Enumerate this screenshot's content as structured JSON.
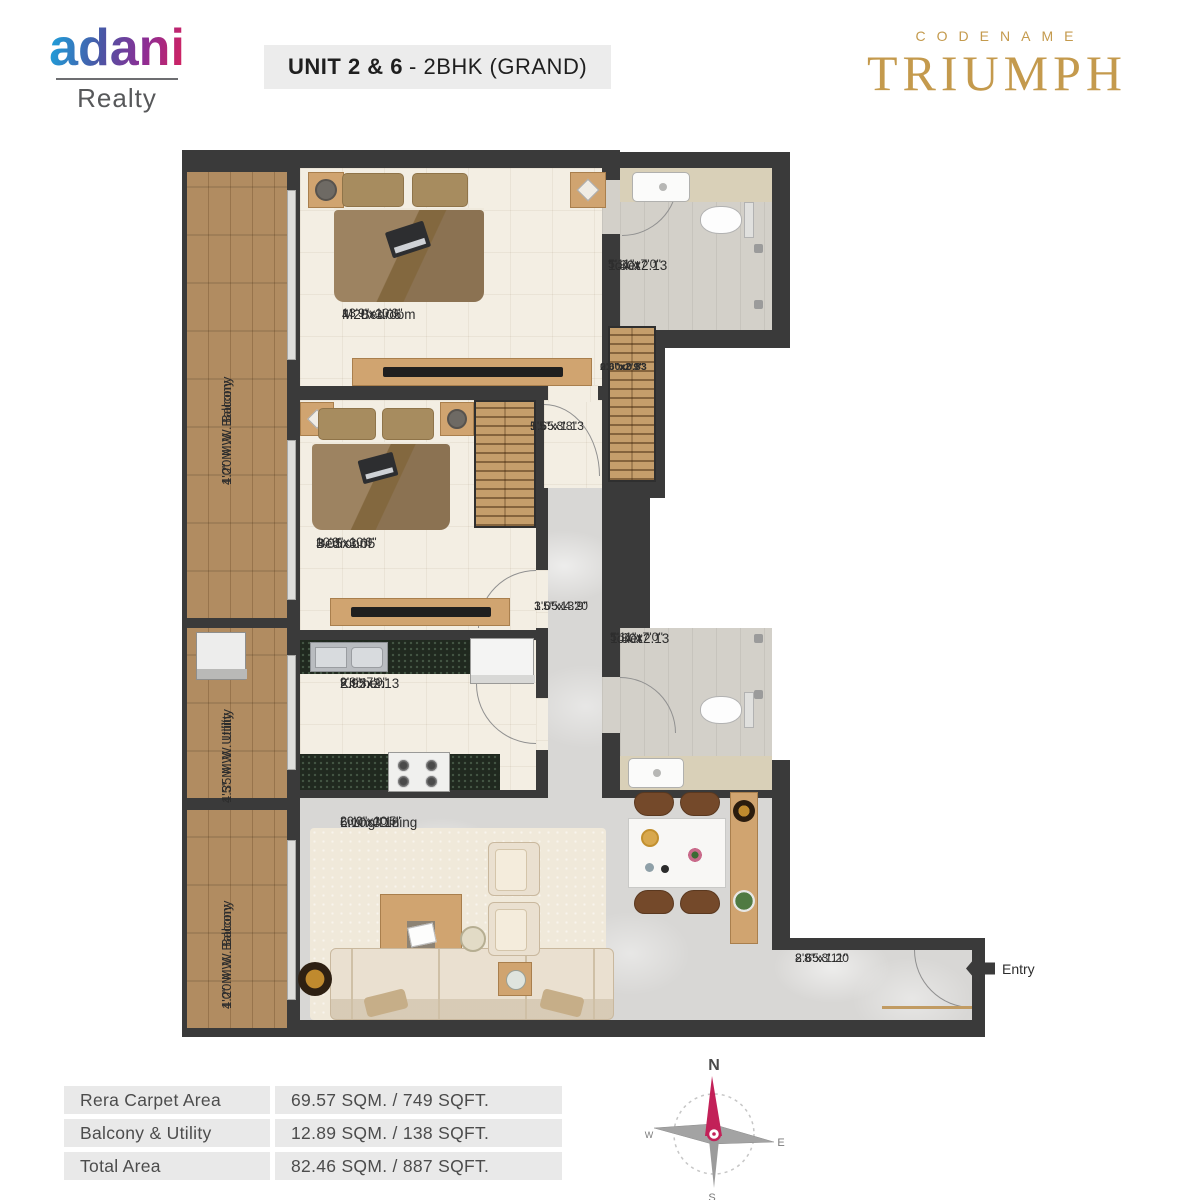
{
  "header": {
    "brand_name": "adani",
    "brand_sub": "Realty",
    "unit_bold": "UNIT 2 & 6",
    "unit_rest": "- 2BHK (GRAND)",
    "project_eyebrow": "CODENAME",
    "project_name": "TRIUMPH"
  },
  "plan": {
    "rooms": [
      {
        "name": "M. Bedroom",
        "metric": "4.20x3.05",
        "imperial": "13'9\"x10'0\""
      },
      {
        "name": "Bedroom",
        "metric": "3.05x3.05",
        "imperial": "10'0\"x10'0\""
      },
      {
        "name": "Kitchen",
        "metric": "2.95x2.13",
        "imperial": "9'8\"x7'0\""
      },
      {
        "name": "Living/Dining",
        "metric": "6.10x3.18",
        "imperial": "20'0\"x10'5\""
      },
      {
        "name": "Toilet",
        "metric": "1.80x2.13",
        "imperial": "5'11\"x7'0\""
      },
      {
        "name": "Toilet",
        "metric": "1.80x2.13",
        "imperial": "5'11\"x7'0\""
      }
    ],
    "spaces": [
      {
        "metric": "1.65x1.13",
        "imperial": "5'5\"x3'8\""
      },
      {
        "metric": "0.60x0.83",
        "imperial": "2'0\"x2'9\""
      },
      {
        "metric": "1.05x4.20",
        "imperial": "3'5\"x13'9\""
      },
      {
        "metric": "2.65x1.20",
        "imperial": "8'8\"x3'11\""
      }
    ],
    "balcony_top": {
      "line1": "1.20 M.W. Balcony",
      "line2": "4'0\" M.W. Balcony"
    },
    "utility": {
      "line1": "1.35 M.W. Utility",
      "line2": "4'5\" M.W. Utility"
    },
    "balcony_bottom": {
      "line1": "1.20 M.W. Balcony",
      "line2": "4'0\" M.W. Balcony"
    },
    "entry_label": "Entry"
  },
  "area_table": {
    "rows": [
      {
        "label": "Rera Carpet Area",
        "value": "69.57 SQM. / 749 SQFT."
      },
      {
        "label": "Balcony & Utility",
        "value": "12.89 SQM. / 138 SQFT."
      },
      {
        "label": "Total Area",
        "value": "82.46 SQM. / 887 SQFT."
      }
    ]
  },
  "compass": {
    "n": "N",
    "e": "E",
    "s": "S",
    "w": "W"
  }
}
